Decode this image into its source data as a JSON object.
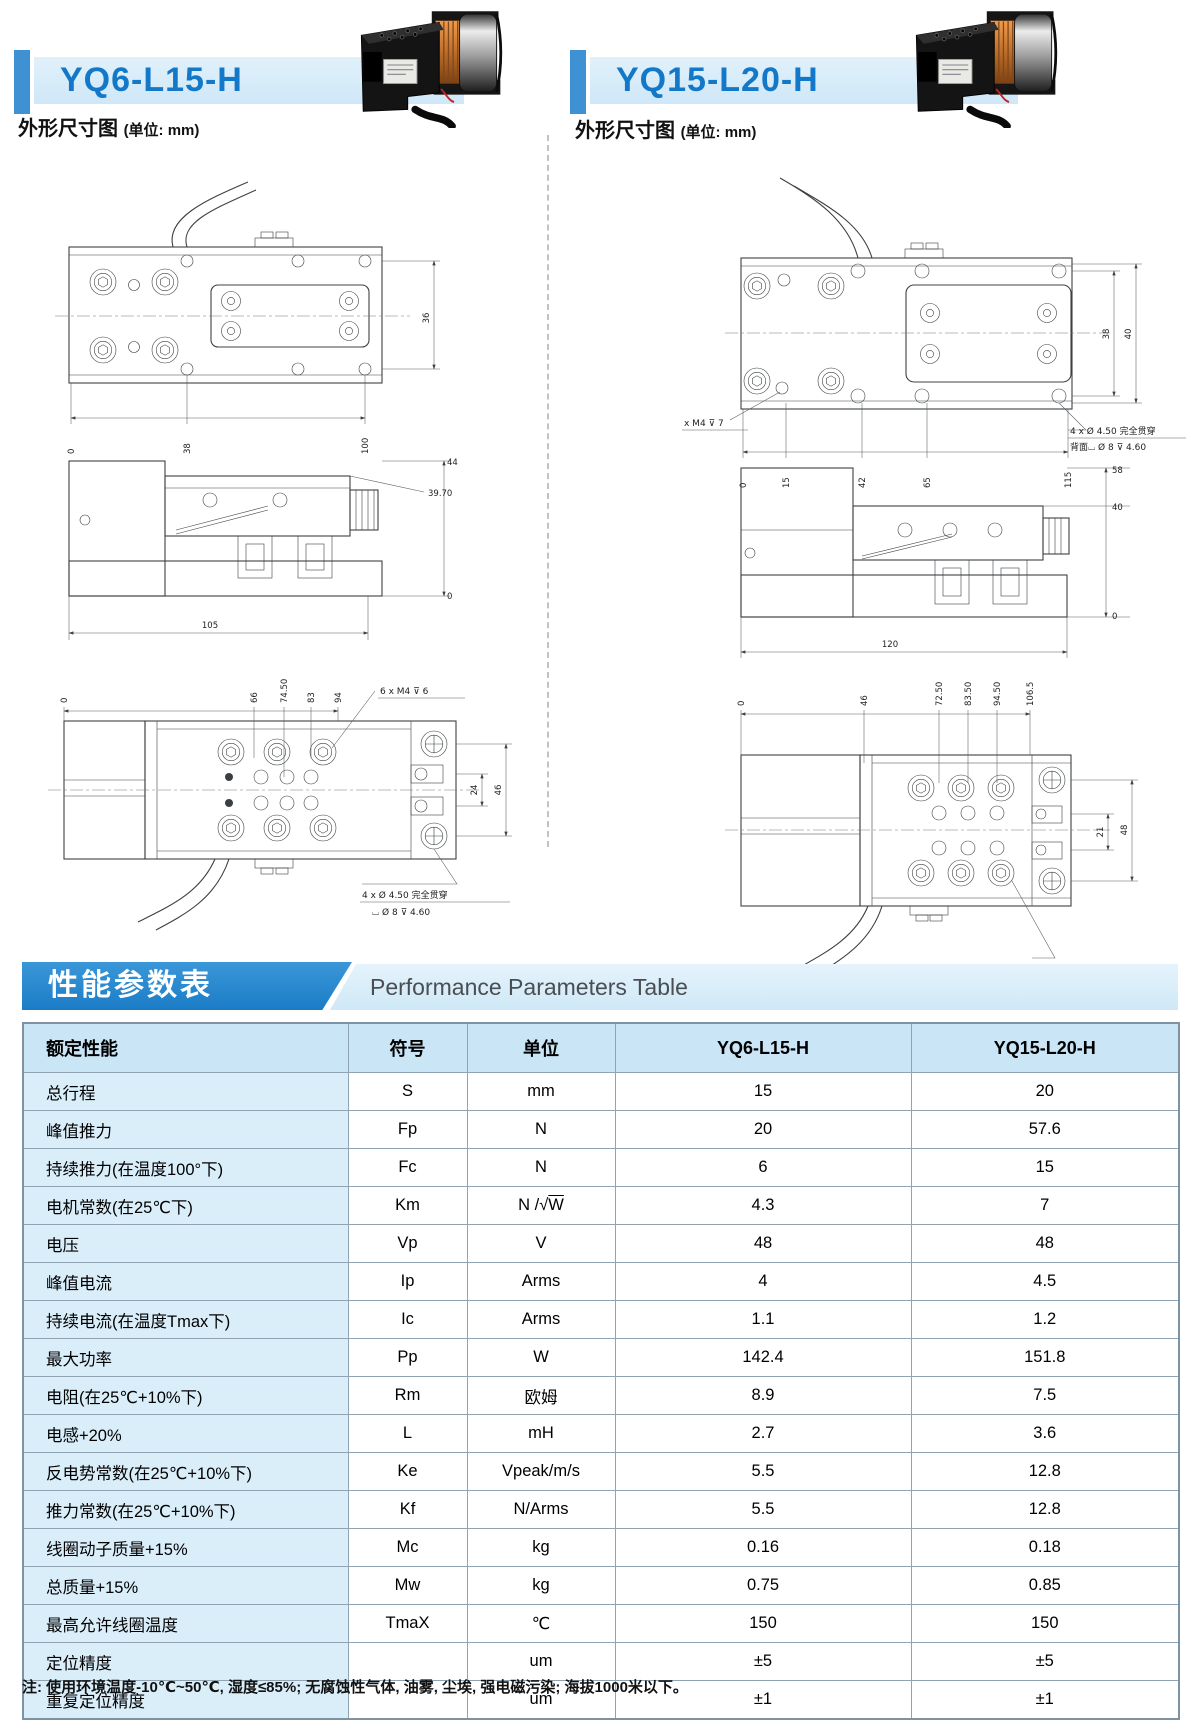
{
  "colors": {
    "title_blue": "#1478c8",
    "accent_bar": "#3e92d4",
    "band_light": "#d7ecf9",
    "banner_blue": "#2a8ad2",
    "table_header_bg": "#c9e5f6",
    "table_first_col_bg": "#daeefa",
    "table_border": "#8fa3b2"
  },
  "products": [
    {
      "title": "YQ6-L15-H",
      "caption": "外形尺寸图",
      "caption_unit": "(单位: mm)"
    },
    {
      "title": "YQ15-L20-H",
      "caption": "外形尺寸图",
      "caption_unit": "(单位: mm)"
    }
  ],
  "banner": {
    "zh": "性能参数表",
    "en": "Performance Parameters Table"
  },
  "table": {
    "headers": [
      "额定性能",
      "符号",
      "单位",
      "YQ6-L15-H",
      "YQ15-L20-H"
    ],
    "rows": [
      [
        "总行程",
        "S",
        "mm",
        "15",
        "20"
      ],
      [
        "峰值推力",
        "Fp",
        "N",
        "20",
        "57.6"
      ],
      [
        "持续推力(在温度100°下)",
        "Fc",
        "N",
        "6",
        "15"
      ],
      [
        "电机常数(在25℃下)",
        "Km",
        "N /√W",
        "4.3",
        "7"
      ],
      [
        "电压",
        "Vp",
        "V",
        "48",
        "48"
      ],
      [
        "峰值电流",
        "Ip",
        "Arms",
        "4",
        "4.5"
      ],
      [
        "持续电流(在温度Tmax下)",
        "Ic",
        "Arms",
        "1.1",
        "1.2"
      ],
      [
        "最大功率",
        "Pp",
        "W",
        "142.4",
        "151.8"
      ],
      [
        "电阻(在25℃+10%下)",
        "Rm",
        "欧姆",
        "8.9",
        "7.5"
      ],
      [
        "电感+20%",
        "L",
        "mH",
        "2.7",
        "3.6"
      ],
      [
        "反电势常数(在25℃+10%下)",
        "Ke",
        "Vpeak/m/s",
        "5.5",
        "12.8"
      ],
      [
        "推力常数(在25℃+10%下)",
        "Kf",
        "N/Arms",
        "5.5",
        "12.8"
      ],
      [
        "线圈动子质量+15%",
        "Mc",
        "kg",
        "0.16",
        "0.18"
      ],
      [
        "总质量+15%",
        "Mw",
        "kg",
        "0.75",
        "0.85"
      ],
      [
        "最高允许线圈温度",
        "TmaX",
        "℃",
        "150",
        "150"
      ],
      [
        "定位精度",
        "",
        "um",
        "±5",
        "±5"
      ],
      [
        "重复定位精度",
        "",
        "um",
        "±1",
        "±1"
      ]
    ]
  },
  "note": "注: 使用环境温度-10℃~50℃, 湿度≤85%; 无腐蚀性气体, 油雾, 尘埃, 强电磁污染; 海拔1000米以下。",
  "drawings": {
    "left": {
      "top_view": {
        "side_dim": "36",
        "bottom_dims": [
          "0",
          "38",
          "100"
        ]
      },
      "side_view": {
        "right_dims": [
          "44",
          "39.70",
          "0"
        ],
        "bottom_dim": "105"
      },
      "bottom_view": {
        "top_dims": [
          "0",
          "66",
          "74.50",
          "83",
          "94"
        ],
        "right_dims": [
          "24",
          "46"
        ],
        "thread_note": "6 x M4 ⊽ 6",
        "hole_note_1": "4 x Ø 4.50 完全贯穿",
        "hole_note_2": "⌴ Ø 8 ⊽ 4.60"
      }
    },
    "right": {
      "top_view": {
        "right_dims": [
          "38",
          "40"
        ],
        "bottom_dims": [
          "0",
          "15",
          "42",
          "65",
          "115"
        ],
        "thread_note": "x M4 ⊽ 7",
        "hole_note_1": "4 x Ø 4.50 完全贯穿",
        "hole_note_2": "背面⌴ Ø 8 ⊽ 4.60"
      },
      "side_view": {
        "right_dims": [
          "58",
          "40",
          "0"
        ],
        "bottom_dim": "120"
      },
      "bottom_view": {
        "top_dims": [
          "0",
          "46",
          "72.50",
          "83.50",
          "94.50",
          "106.5"
        ],
        "right_dims": [
          "21",
          "48"
        ],
        "thread_note": "6 x M4 ⊽ 8"
      }
    }
  }
}
